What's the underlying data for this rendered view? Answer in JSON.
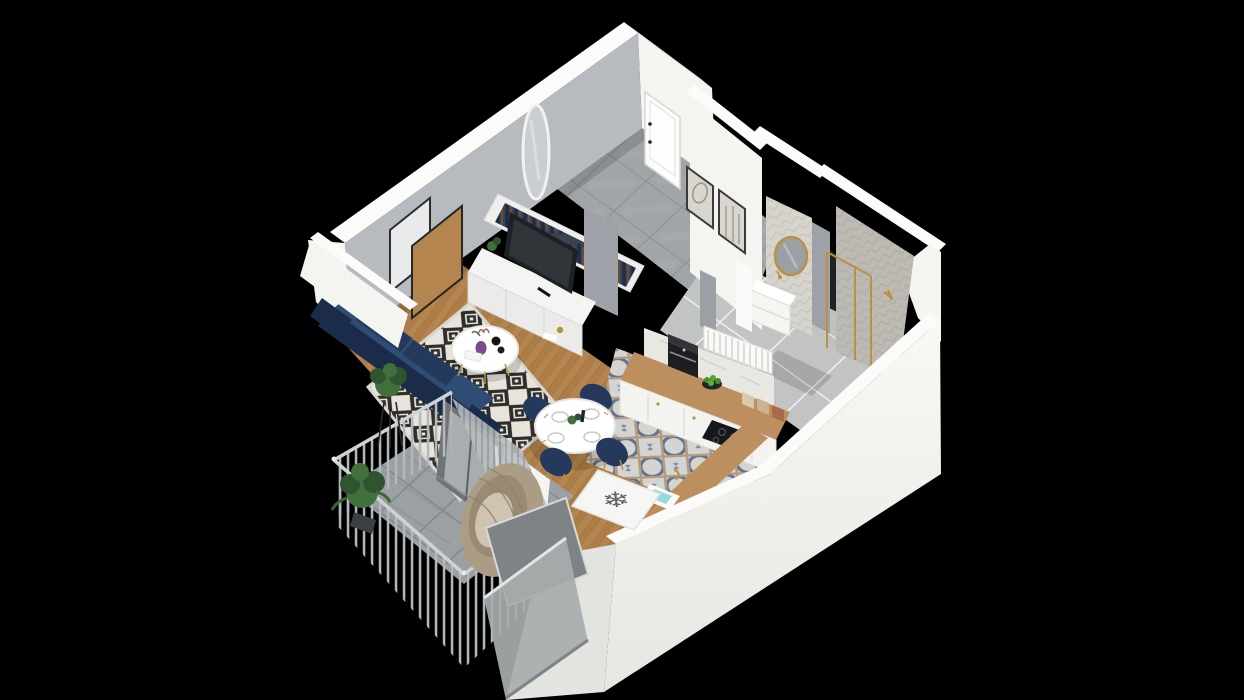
{
  "scene": {
    "kind": "3d-isometric-floor-plan-render",
    "description": "Photoreal 3D cutaway floor plan of a small studio apartment with balcony, viewed from above at an angle, on a black background",
    "background": "#000000"
  },
  "icons": {
    "freezer_glyph": "❄"
  },
  "palette": {
    "bg": "#000000",
    "wall_white": "#f4f4f1",
    "wall_white_shade": "#e3e3df",
    "wall_top": "#fbfbf9",
    "wall_gray": "#b7babf",
    "wall_gray_dark": "#9ea2a8",
    "wood": "#b5854f",
    "wood_dark": "#a0703f",
    "wood_line": "#8a5f34",
    "rug_base": "#e7e4db",
    "rug_dark": "#2e2d2a",
    "tile_hall": "#a2a5a7",
    "tile_hall_grout": "#8e9193",
    "tile_bath": "#c2c4c3",
    "tile_kitchen": "#d4d5d1",
    "kitchen_motif": "#5f7292",
    "kitchen_motif2": "#b59a7e",
    "tile_balcony": "#9ba0a2",
    "tile_wall": "#d6d4cc",
    "tile_wall_line": "#c5c2b8",
    "navy": "#24395c",
    "navy_dark": "#1b2c4a",
    "navy_mid": "#2e4c74",
    "gold": "#b9913f",
    "counter_wood": "#bd8e5e",
    "tv_dark": "#1e2124",
    "marble": "#e9e7e2",
    "glass": "#b3b8ba",
    "curtain": "#b9bec1",
    "curtain_line": "#878d91",
    "railing": "#b4b8bb",
    "screen_gray": "#7e8386",
    "rattan": "#ab9c86",
    "plant": "#41703c",
    "plant_dark": "#2f5430",
    "wardrobe_bg": "#3c4350",
    "clothes_brown": "#6a4f38",
    "snowflake_color": "#5e6367"
  },
  "rooms": [
    {
      "name": "Living room",
      "items": [
        "navy sofa",
        "diamond pattern rug",
        "round coffee table with purple vase",
        "white TV console",
        "flat-screen TV",
        "two overlapping wall frames",
        "herringbone wood floor"
      ]
    },
    {
      "name": "Hallway",
      "items": [
        "white entrance door",
        "oval wall mirror",
        "open wardrobe with hanging clothes",
        "gray concrete floor tiles",
        "two framed prints",
        "white radiator"
      ]
    },
    {
      "name": "Kitchen",
      "items": [
        "white cabinets with wood counter",
        "coffee machine",
        "bowl of green apples",
        "black cooktop",
        "sink with gold faucet",
        "fridge marked with snowflake symbol",
        "ornate patterned floor tiles"
      ]
    },
    {
      "name": "Dining area",
      "items": [
        "round white table with place settings",
        "four navy chairs with gold legs",
        "sheer gray curtain"
      ]
    },
    {
      "name": "Bathroom",
      "items": [
        "herringbone tiled walls",
        "round gold mirror",
        "white vanity with sink",
        "glass shower with gold trim",
        "gray tile floor"
      ]
    },
    {
      "name": "Balcony",
      "items": [
        "vertical bar metal railing",
        "hanging rattan egg chair",
        "potted plants",
        "gray privacy screen",
        "tile floor",
        "glass balustrade"
      ]
    }
  ]
}
